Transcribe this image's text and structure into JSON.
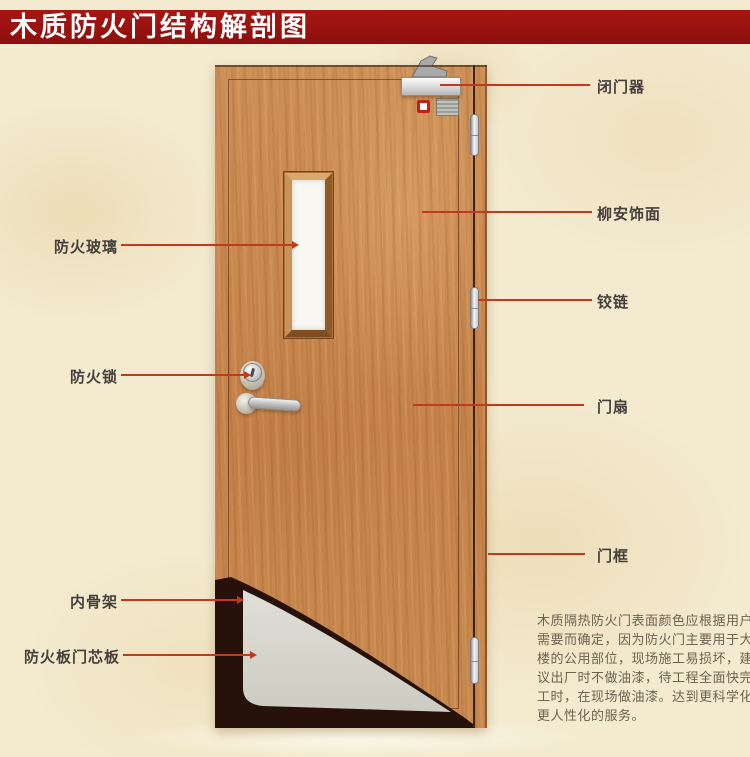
{
  "title": "木质防火门结构解剖图",
  "callouts": {
    "left": [
      {
        "label": "防火玻璃"
      },
      {
        "label": "防火锁"
      },
      {
        "label": "内骨架"
      },
      {
        "label": "防火板门芯板"
      }
    ],
    "right": [
      {
        "label": "闭门器"
      },
      {
        "label": "柳安饰面"
      },
      {
        "label": "铰链"
      },
      {
        "label": "门扇"
      },
      {
        "label": "门框"
      }
    ]
  },
  "description": {
    "lines": [
      "木质隔热防火门表面颜色应根据用户",
      "需要而确定，因为防火门主要用于大",
      "楼的公用部位，现场施工易损坏，建",
      "议出厂时不做油漆，待工程全面快完",
      "工时，在现场做油漆。达到更科学化",
      "更人性化的服务。"
    ]
  },
  "colors": {
    "banner_red": "#9c1210",
    "callout_line_red": "#c23a1e",
    "door_wood": "#c88a50",
    "core_board_gray": "#d9d8d0",
    "inner_skeleton_dark": "#26120a",
    "label_text": "#45403a",
    "description_text": "#6e6251",
    "background_parchment": "#f3ead0"
  }
}
